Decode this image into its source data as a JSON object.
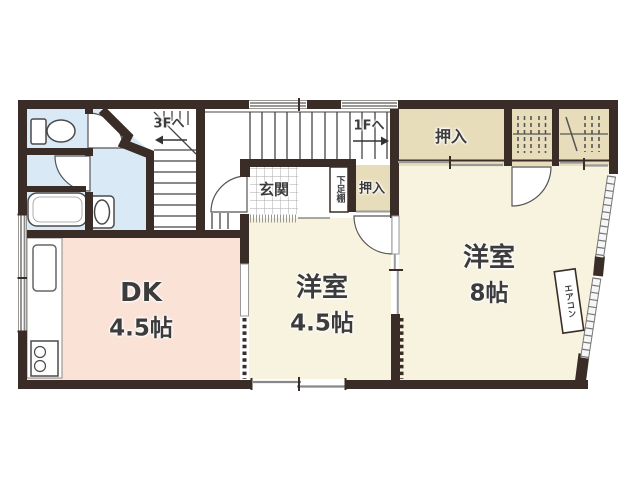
{
  "palette": {
    "wall": "#3a2d27",
    "water_area": "#d9eaf6",
    "dk_room": "#fae2d6",
    "western_room": "#f8f3df",
    "closet": "#e8ddbb",
    "line_gray": "#999999",
    "text": "#3c3c3c"
  },
  "rooms": {
    "dk": {
      "name": "DK",
      "size": "4.5帖"
    },
    "western_small": {
      "name": "洋室",
      "size": "4.5帖"
    },
    "western_large": {
      "name": "洋室",
      "size": "8帖"
    }
  },
  "labels": {
    "closet_large": "押入",
    "closet_small": "押入",
    "entrance": "玄関",
    "shoe_shelf": "下足棚",
    "stairs_up": "3Fへ",
    "stairs_down": "1Fへ",
    "aircon": "エアコン"
  },
  "icons": [
    "toilet-icon",
    "bathtub-icon",
    "washbasin-icon",
    "kitchen-sink-icon",
    "stove-icon"
  ]
}
